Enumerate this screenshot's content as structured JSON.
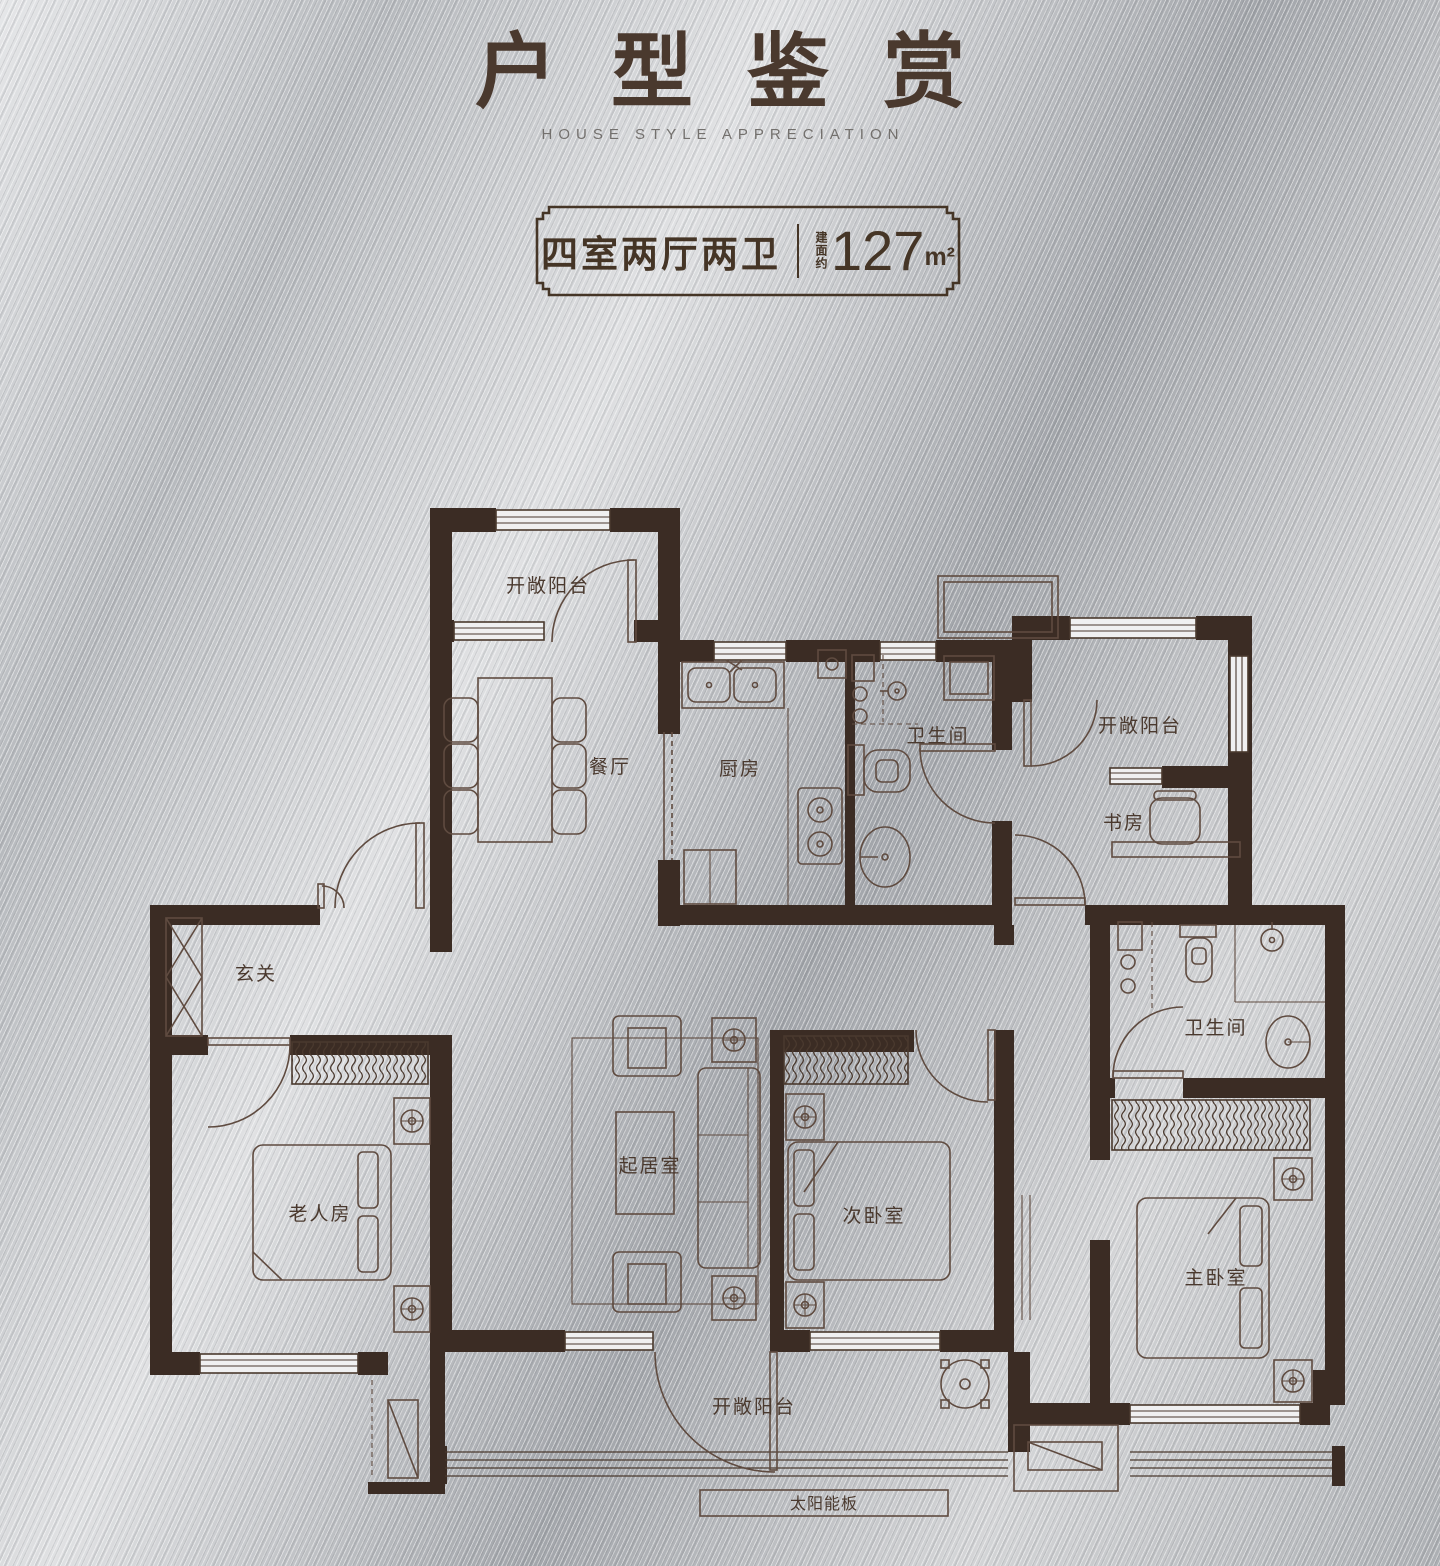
{
  "header": {
    "title": "户型鉴赏",
    "subtitle": "HOUSE STYLE APPRECIATION"
  },
  "badge": {
    "layout": "四室两厅两卫",
    "area_label": "建面约",
    "area_value": "127",
    "area_unit": "m²"
  },
  "floor_plan": {
    "rooms": {
      "balcony_top_left": "开敞阳台",
      "dining_room": "餐厅",
      "kitchen": "厨房",
      "bathroom": "卫生间",
      "balcony_top_right": "开敞阳台",
      "study": "书房",
      "entry": "玄关",
      "elder_room": "老人房",
      "living_room": "起居室",
      "second_bedroom": "次卧室",
      "master_bathroom": "卫生间",
      "master_bedroom": "主卧室",
      "balcony_bottom": "开敞阳台",
      "solar_panel": "太阳能板"
    }
  }
}
